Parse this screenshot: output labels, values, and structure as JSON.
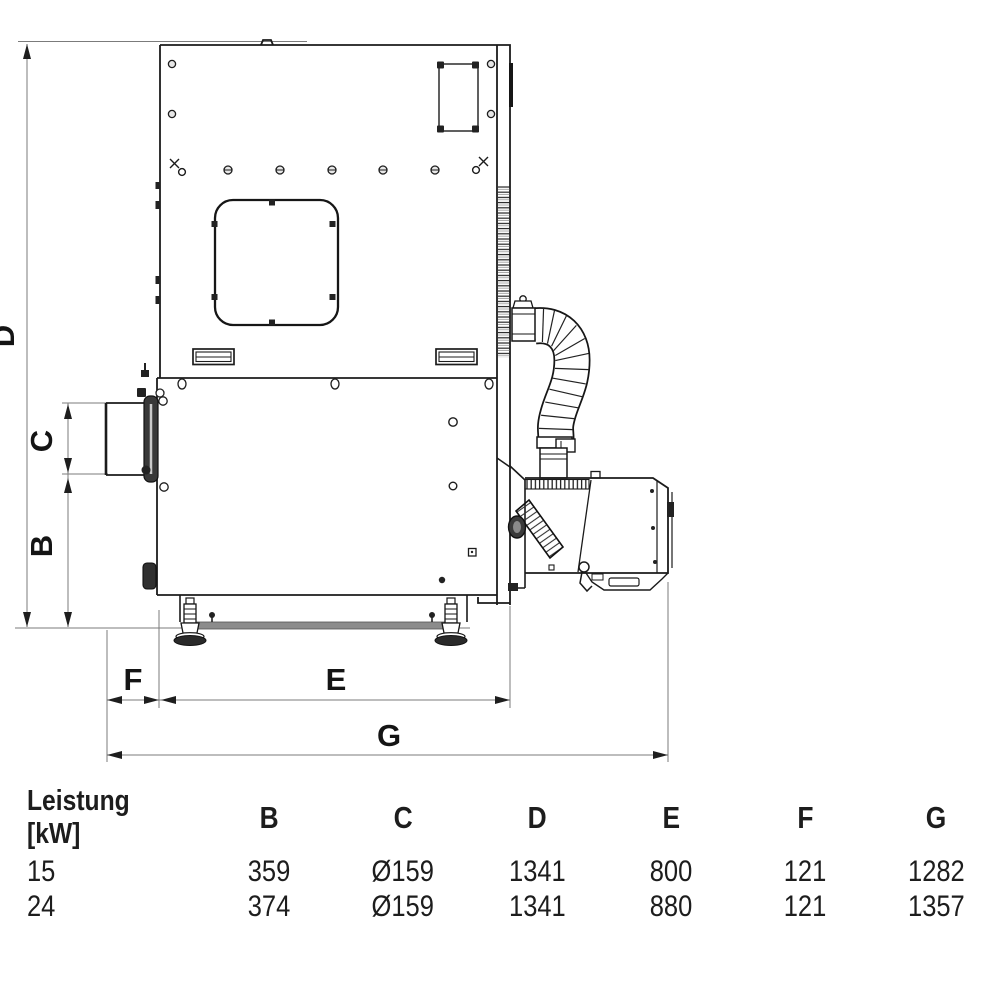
{
  "dims": {
    "D": "D",
    "C": "C",
    "B": "B",
    "F": "F",
    "E": "E",
    "G": "G"
  },
  "table": {
    "power_label": "Leistung",
    "power_unit": "[kW]",
    "columns": [
      "B",
      "C",
      "D",
      "E",
      "F",
      "G"
    ],
    "rows": [
      {
        "power": "15",
        "values": [
          "359",
          "Ø159",
          "1341",
          "800",
          "121",
          "1282"
        ]
      },
      {
        "power": "24",
        "values": [
          "374",
          "Ø159",
          "1341",
          "880",
          "121",
          "1357"
        ]
      }
    ]
  }
}
